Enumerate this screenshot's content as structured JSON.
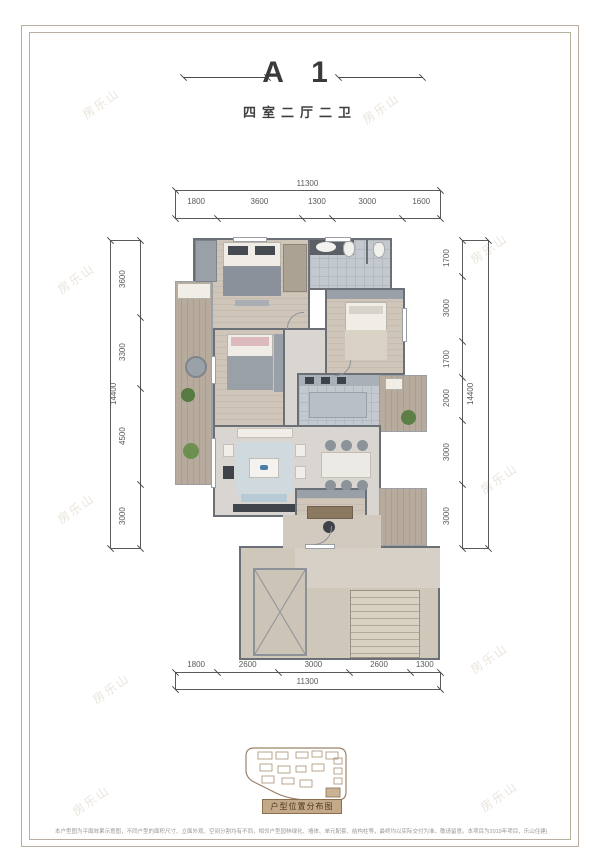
{
  "header": {
    "title": "A 1",
    "subtitle": "四室二厅二卫"
  },
  "dimensions": {
    "top": {
      "total": 11300,
      "segments": [
        1800,
        3600,
        1300,
        3000,
        1600
      ]
    },
    "bottom": {
      "total": 11300,
      "segments": [
        1800,
        2600,
        3000,
        2600,
        1300
      ]
    },
    "left": {
      "total": 14400,
      "segments": [
        3600,
        3300,
        4500,
        3000
      ]
    },
    "right": {
      "total": 14400,
      "segments": [
        1700,
        3000,
        1700,
        2000,
        3000,
        3000
      ]
    }
  },
  "minimap": {
    "label": "户型位置分布图"
  },
  "watermark": {
    "text": "房乐山"
  },
  "footer": {
    "disclaimer": "本户型图为平面效果示意图，不同户型的面积尺寸、立面外观、空间分割均有不同，相邻户型园林绿化、墙体、单元配套、结构柱等，最终均以实际交付为准，敬请留意。本项目为2019年项目，乐山住建(2019)房预售证第17号"
  },
  "palette": {
    "wall": "#6b7077",
    "wood_floor": "#cbc2b5",
    "tile_floor": "#c4c9cf",
    "light_floor": "#d9d6d2",
    "public_floor": "#cfc7ba",
    "balcony_wood": "#b0a596",
    "accent_tan": "#a98f6f",
    "plant_green": "#5d7f47",
    "rug_blue": "#cfd9de"
  }
}
